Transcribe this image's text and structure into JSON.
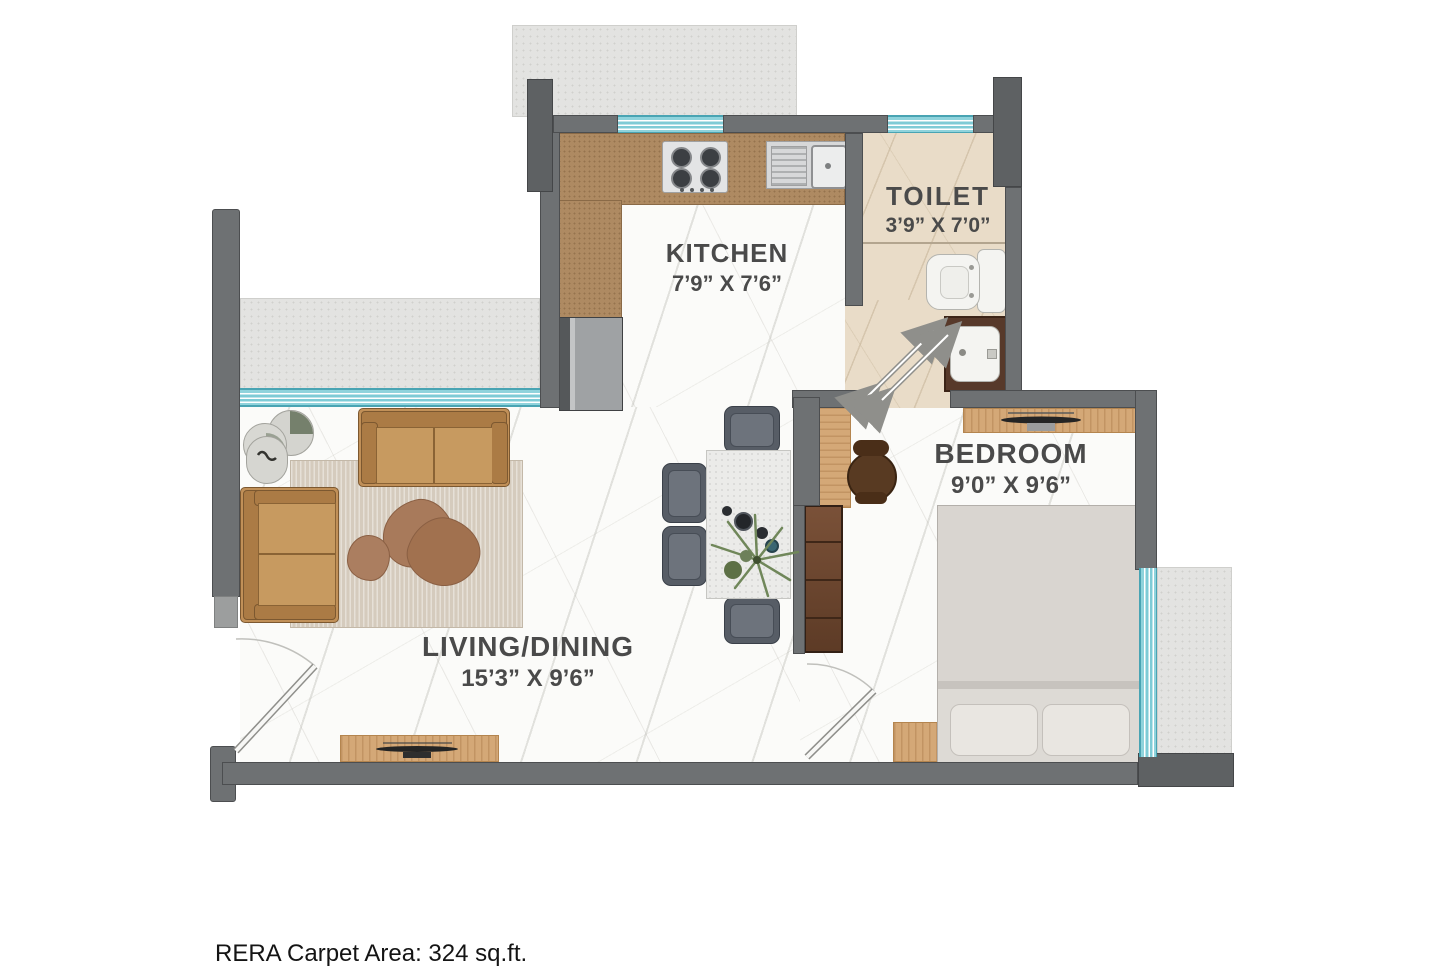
{
  "labels": {
    "kitchen": {
      "name": "KITCHEN",
      "size": "7’9” X 7’6”"
    },
    "toilet": {
      "name": "TOILET",
      "size": "3’9” X 7’0”"
    },
    "bedroom": {
      "name": "BEDROOM",
      "size": "9’0” X 9’6”"
    },
    "living_dining": {
      "name": "LIVING/DINING",
      "size": "15’3” X 9’6”"
    }
  },
  "footer": {
    "rera_carpet_area": "RERA Carpet Area: 324 sq.ft."
  },
  "palette": {
    "wall_gray": "#6e7173",
    "window_teal": "#7ecbd6",
    "kitchen_counter": "#ae8a62",
    "wood": "#d4a877",
    "sofa_tan": "#c19058",
    "rug": "#d5cbbd",
    "toilet_floor": "#e9dcc8",
    "exterior_deck": "#e3e3e1",
    "bed": "#d9d5d0",
    "wardrobe": "#5d3b26",
    "dining_chair": "#575d66",
    "label_text": "#4a4a4a"
  }
}
